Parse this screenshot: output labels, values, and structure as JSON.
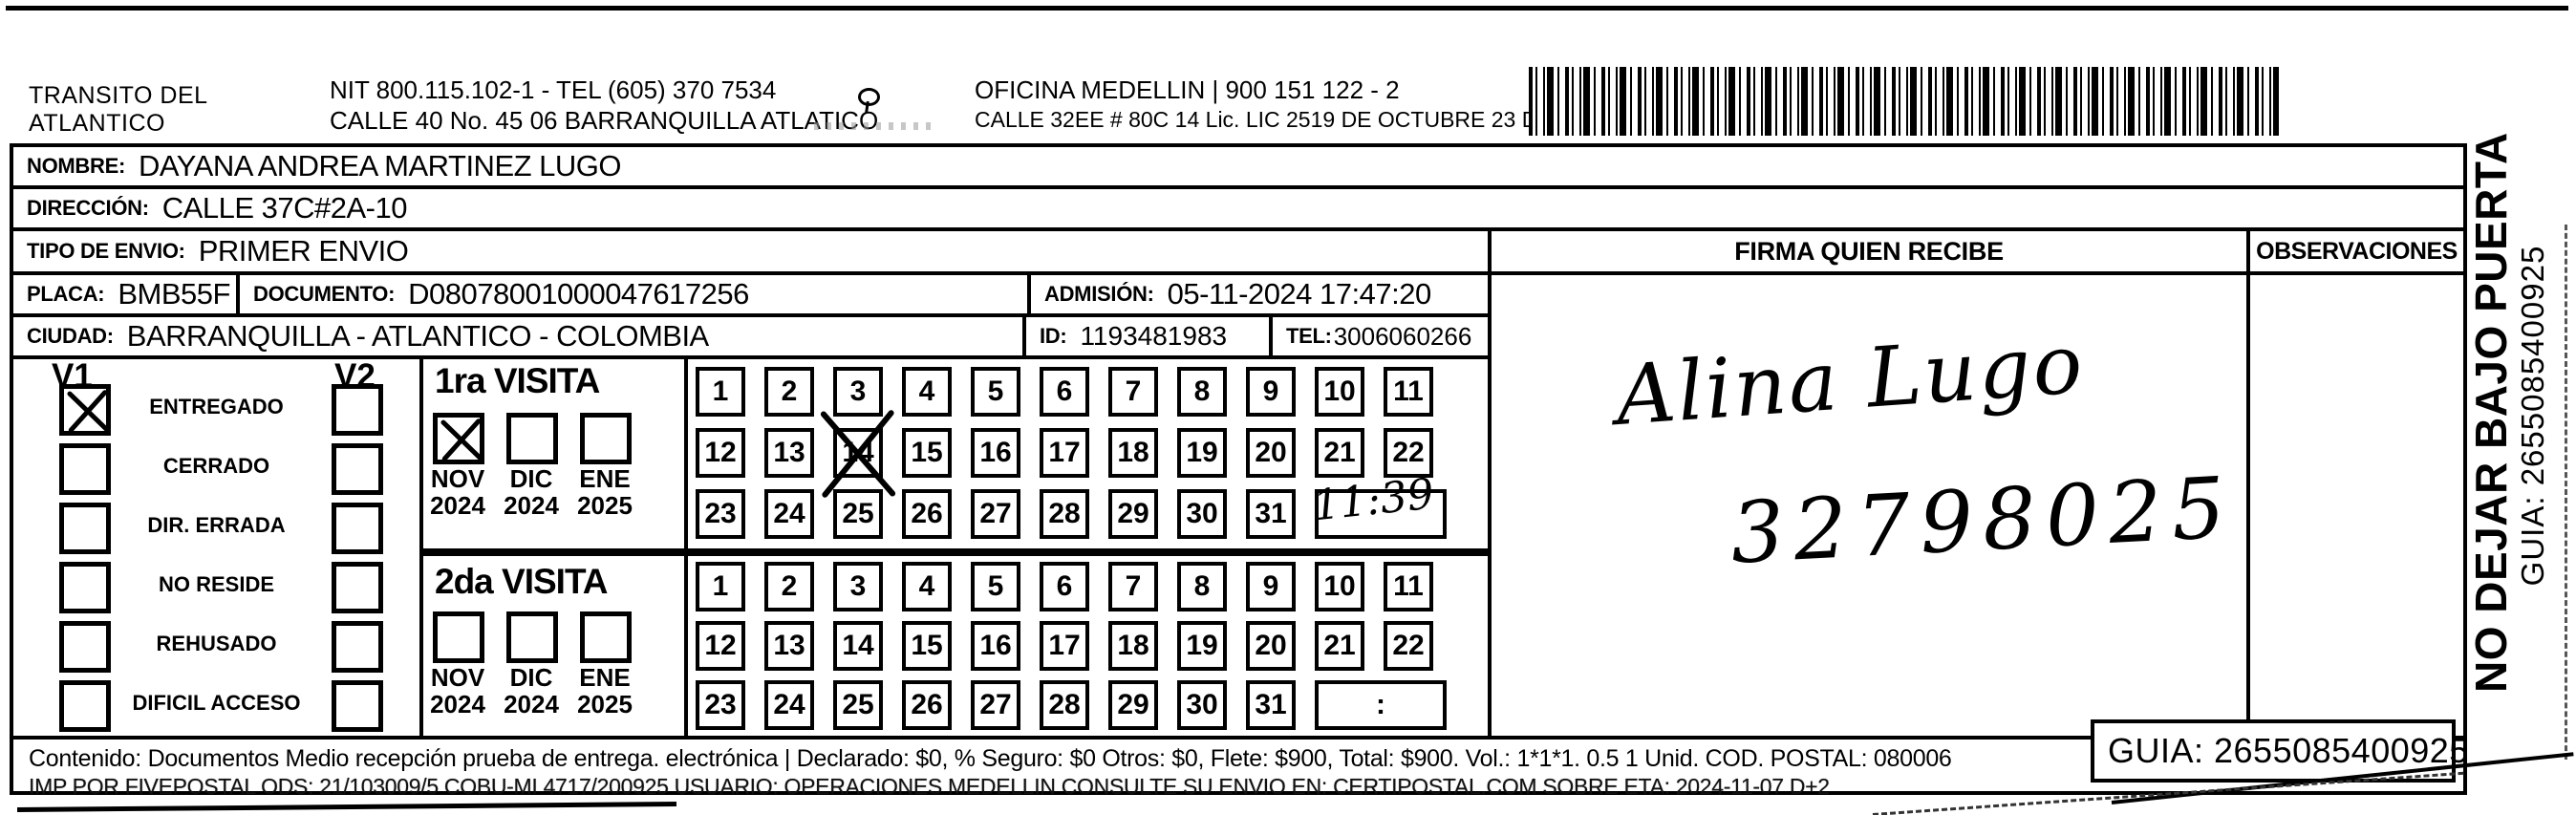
{
  "header": {
    "company_line1": "TRANSITO DEL",
    "company_line2": "ATLANTICO",
    "nit_line": "NIT 800.115.102-1 - TEL (605) 370 7534",
    "address_line": "CALLE 40 No. 45 06 BARRANQUILLA ATLATICO",
    "office_line": "OFICINA MEDELLIN | 900 151 122 - 2",
    "office_address": "CALLE 32EE # 80C 14 Lic. LIC 2519 DE OCTUBRE 23 DE 2015"
  },
  "recipient": {
    "name_label": "NOMBRE:",
    "name": "DAYANA ANDREA MARTINEZ LUGO",
    "address_label": "DIRECCIÓN:",
    "address": "CALLE 37C#2A-10",
    "type_label": "TIPO DE ENVIO:",
    "type": "PRIMER ENVIO",
    "placa_label": "PLACA:",
    "placa": "BMB55F",
    "doc_label": "DOCUMENTO:",
    "doc": "D08078001000047617256",
    "admission_label": "ADMISIÓN:",
    "admission": "05-11-2024 17:47:20",
    "city_label": "CIUDAD:",
    "city": "BARRANQUILLA - ATLANTICO - COLOMBIA",
    "id_label": "ID:",
    "id": "1193481983",
    "tel_label": "TEL:",
    "tel": "3006060266"
  },
  "status": {
    "v1_label": "V1",
    "v2_label": "V2",
    "options": [
      {
        "label": "ENTREGADO",
        "v1": true,
        "v2": false
      },
      {
        "label": "CERRADO",
        "v1": false,
        "v2": false
      },
      {
        "label": "DIR. ERRADA",
        "v1": false,
        "v2": false
      },
      {
        "label": "NO RESIDE",
        "v1": false,
        "v2": false
      },
      {
        "label": "REHUSADO",
        "v1": false,
        "v2": false
      },
      {
        "label": "DIFICIL ACCESO",
        "v1": false,
        "v2": false
      }
    ]
  },
  "visits": {
    "first": {
      "title": "1ra VISITA",
      "months": [
        {
          "name": "NOV",
          "year": "2024",
          "checked": true
        },
        {
          "name": "DIC",
          "year": "2024",
          "checked": false
        },
        {
          "name": "ENE",
          "year": "2025",
          "checked": false
        }
      ],
      "days": [
        1,
        2,
        3,
        4,
        5,
        6,
        7,
        8,
        9,
        10,
        11,
        12,
        13,
        14,
        15,
        16,
        17,
        18,
        19,
        20,
        21,
        22,
        23,
        24,
        25,
        26,
        27,
        28,
        29,
        30,
        31
      ],
      "marked_day": 14,
      "time": "11:39"
    },
    "second": {
      "title": "2da VISITA",
      "months": [
        {
          "name": "NOV",
          "year": "2024",
          "checked": false
        },
        {
          "name": "DIC",
          "year": "2024",
          "checked": false
        },
        {
          "name": "ENE",
          "year": "2025",
          "checked": false
        }
      ],
      "days": [
        1,
        2,
        3,
        4,
        5,
        6,
        7,
        8,
        9,
        10,
        11,
        12,
        13,
        14,
        15,
        16,
        17,
        18,
        19,
        20,
        21,
        22,
        23,
        24,
        25,
        26,
        27,
        28,
        29,
        30,
        31
      ],
      "marked_day": null,
      "time": ":"
    }
  },
  "signature": {
    "header": "FIRMA QUIEN RECIBE",
    "name": "Alina Lugo",
    "phone": "32798025"
  },
  "observations": {
    "header": "OBSERVACIONES"
  },
  "side": {
    "warning": "NO DEJAR BAJO PUERTA",
    "guia": "GUIA: 2655085400925"
  },
  "footer": {
    "line1": "Contenido: Documentos Medio recepción prueba de entrega. electrónica | Declarado: $0, % Seguro: $0  Otros: $0, Flete: $900, Total: $900. Vol.: 1*1*1. 0.5  1 Unid. COD. POSTAL: 080006",
    "line2": "IMP POR FIVEPOSTAL ODS: 21/103009/5 COBU-MI 4717/200925 USUARIO: OPERACIONES MEDELLIN CONSULTE SU ENVIO EN: CERTIPOSTAL.COM SOBRE ETA: 2024-11-07 D+2",
    "guia_box": "GUIA: 2655085400925"
  }
}
